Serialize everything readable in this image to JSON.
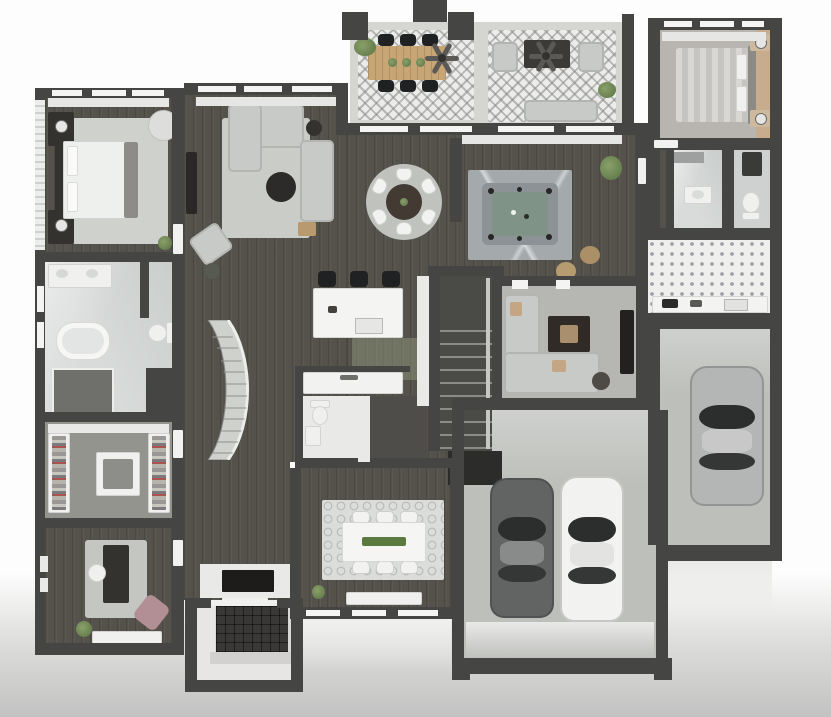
{
  "title": "3D top-down residential floor plan rendering",
  "palette": {
    "bg_top": "#fdfdfd",
    "bg_bottom": "#c2c2c2",
    "wall": "#454543",
    "wood": "#55524b",
    "marble": "#d8dbd9",
    "concrete": "#bdbfbb",
    "rug": "#c9ccc7",
    "sofa": "#c8cac7",
    "furn_dark": "#34322f",
    "felt": "#7f9486",
    "plant": "#67804f",
    "car_dark": "#616463",
    "car_white": "#f2f2f0",
    "car_silver": "#b4b6b5",
    "accent_tan": "#c8ac8e",
    "mauve": "#b18f94",
    "runner_green": "#5a7a3f"
  },
  "rooms": [
    {
      "id": "master-bedroom",
      "label": "Master Bedroom",
      "furniture": [
        "bed",
        "headboard",
        "nightstand x2",
        "table lamp x2",
        "area rug",
        "round accent chair",
        "plant"
      ]
    },
    {
      "id": "master-bathroom",
      "label": "Master Bathroom",
      "furniture": [
        "double vanity",
        "freestanding tub",
        "walk-in shower",
        "toilet"
      ]
    },
    {
      "id": "walk-in-closet",
      "label": "Walk-in Closet",
      "furniture": [
        "hanging racks x2",
        "center island"
      ]
    },
    {
      "id": "home-office",
      "label": "Home Office / Den",
      "furniture": [
        "desk",
        "desk chair",
        "accent chaise",
        "console table",
        "plant",
        "wall art"
      ]
    },
    {
      "id": "living-room",
      "label": "Living Room",
      "furniture": [
        "sectional sofa",
        "round coffee table",
        "armchair",
        "ottoman",
        "media console",
        "side table",
        "basket"
      ]
    },
    {
      "id": "breakfast-nook",
      "label": "Breakfast Nook",
      "furniture": [
        "round dining table",
        "dining chair x6",
        "round rug"
      ]
    },
    {
      "id": "kitchen",
      "label": "Kitchen",
      "furniture": [
        "marble island",
        "bar stool x3",
        "sink",
        "tall cabinets",
        "runner mat"
      ]
    },
    {
      "id": "powder-room",
      "label": "Powder Room / Pool Bath",
      "furniture": [
        "marble vanity counter",
        "toilet",
        "small vanity",
        "shower room"
      ]
    },
    {
      "id": "covered-patio",
      "label": "Covered Patio",
      "furniture": [
        "wood dining table",
        "outdoor chair x6",
        "ceiling fan x2",
        "lounge chair x2",
        "coffee table",
        "outdoor sofa",
        "planters"
      ]
    },
    {
      "id": "billiards-room",
      "label": "Billiards Room",
      "furniture": [
        "pool table",
        "marble rug",
        "pouf x2",
        "plant"
      ]
    },
    {
      "id": "family-room",
      "label": "Family Room",
      "furniture": [
        "sectional sofa",
        "square coffee table",
        "tv console",
        "side table"
      ]
    },
    {
      "id": "bedroom-2",
      "label": "Bedroom 2",
      "furniture": [
        "bed",
        "nightstand x2",
        "lamp x2",
        "accent wall"
      ]
    },
    {
      "id": "guest-bathroom",
      "label": "Guest Bathroom",
      "furniture": [
        "vanity",
        "mirror cabinet",
        "shower",
        "toilet"
      ]
    },
    {
      "id": "laundry-room",
      "label": "Laundry / Mudroom",
      "furniture": [
        "counter",
        "washer",
        "dryer",
        "patterned tile"
      ]
    },
    {
      "id": "dining-room",
      "label": "Formal Dining Room",
      "furniture": [
        "dining table",
        "green runner",
        "dining chair x6",
        "patterned rug",
        "sideboard",
        "plant"
      ]
    },
    {
      "id": "entry-porch",
      "label": "Entry Porch",
      "furniture": [
        "dark brick inlay",
        "steps",
        "fireplace"
      ]
    },
    {
      "id": "two-car-garage",
      "label": "2-Car Garage",
      "furniture": [
        "dark gray car",
        "white car"
      ]
    },
    {
      "id": "single-car-garage",
      "label": "Single Garage",
      "furniture": [
        "silver car"
      ]
    },
    {
      "id": "staircase-straight",
      "label": "Main Staircase"
    },
    {
      "id": "staircase-curved",
      "label": "Curved Staircase"
    }
  ]
}
